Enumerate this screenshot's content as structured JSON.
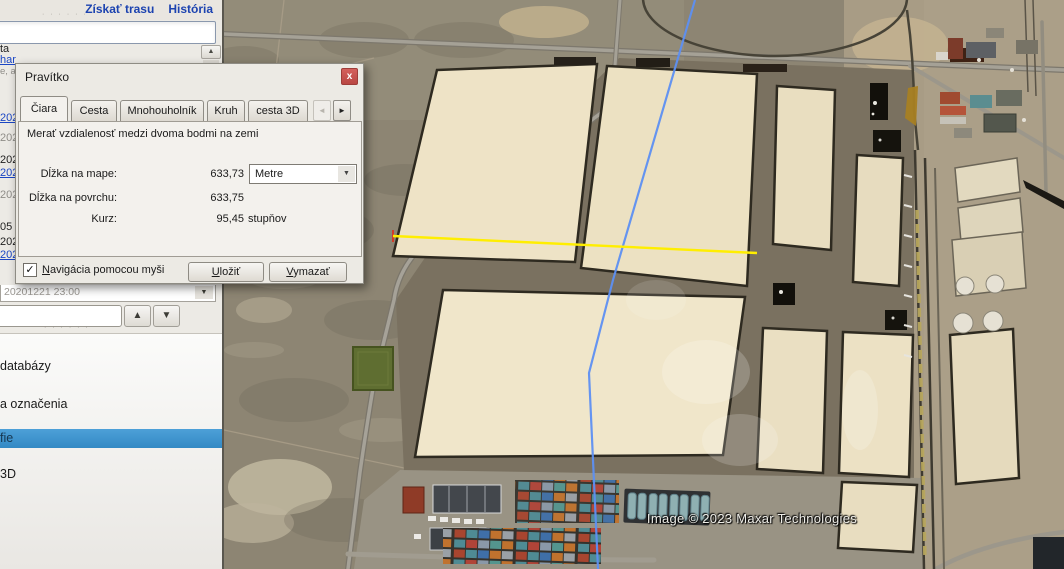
{
  "sidebar": {
    "top_links": [
      {
        "label": "Získať trasu"
      },
      {
        "label": "História"
      }
    ],
    "search_input_value": "",
    "fragments": [
      {
        "text": "ta"
      },
      {
        "text": "har"
      },
      {
        "text": "e, a"
      },
      {
        "text": "202"
      },
      {
        "text": "202"
      },
      {
        "text": "202"
      },
      {
        "text": "202"
      },
      {
        "text": "202"
      },
      {
        "text": "05 M"
      },
      {
        "text": "202"
      },
      {
        "text": "202"
      }
    ],
    "history_combo_value": "20201221 23:00",
    "nav_input_value": "",
    "layers": {
      "items": [
        {
          "label": "databázy"
        },
        {
          "label": "a označenia"
        },
        {
          "label": "fie",
          "selected": true
        },
        {
          "label": "3D"
        }
      ]
    }
  },
  "dialog": {
    "title": "Pravítko",
    "tabs": [
      {
        "label": "Čiara",
        "active": true
      },
      {
        "label": "Cesta"
      },
      {
        "label": "Mnohouholník"
      },
      {
        "label": "Kruh"
      },
      {
        "label": "cesta 3D"
      }
    ],
    "description": "Merať vzdialenosť medzi dvoma bodmi na zemi",
    "rows": [
      {
        "label": "Dĺžka na mape:",
        "value": "633,73"
      },
      {
        "label": "Dĺžka na povrchu:",
        "value": "633,75"
      },
      {
        "label": "Kurz:",
        "value": "95,45",
        "unit": "stupňov"
      }
    ],
    "unit_select": {
      "value": "Metre"
    },
    "checkbox": {
      "mnemonic": "N",
      "rest": "avigácia pomocou myši",
      "checked": true
    },
    "buttons": {
      "save": {
        "mnemonic": "U",
        "rest": "ložiť"
      },
      "clear": {
        "mnemonic": "V",
        "rest": "ymazať"
      }
    }
  },
  "map": {
    "attribution": "Image © 2023 Maxar Technologies",
    "measure_line_color": "#ffee00",
    "path_color": "#5d8ff2"
  },
  "colors": {
    "link_blue": "#1c43b0",
    "selection_blue": "#3d96d2",
    "close_red": "#c4524e"
  },
  "icons": {
    "close": "x",
    "check": "✓",
    "arrow_up": "▲",
    "arrow_down": "▼",
    "combo_arrow": "▼",
    "tab_prev": "◄",
    "tab_next": "►",
    "scroll_up": "▲",
    "splitter_dots": "· · · · · ·"
  }
}
